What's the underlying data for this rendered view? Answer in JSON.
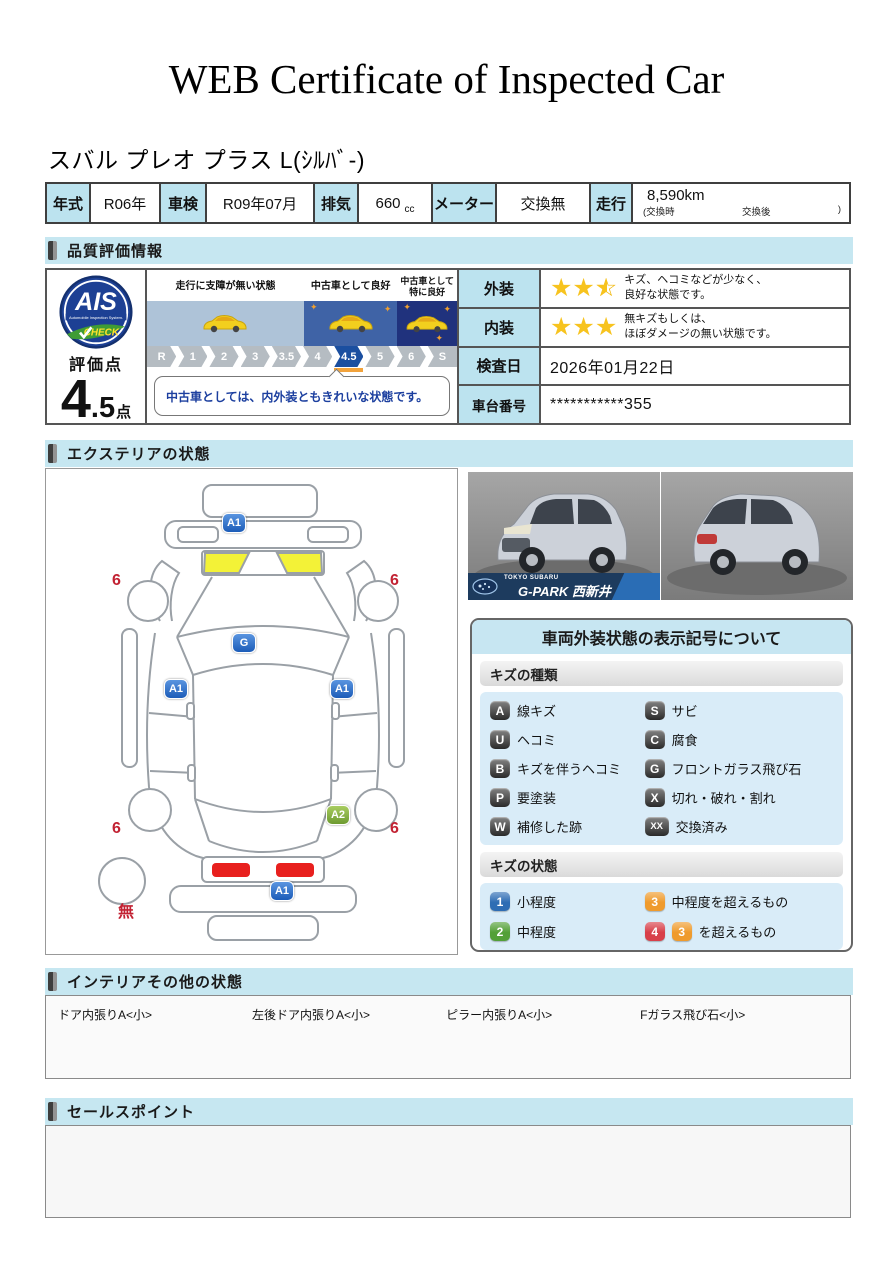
{
  "page": {
    "title": "WEB Certificate of Inspected Car"
  },
  "vehicle": {
    "name": "スバル プレオ プラス L(ｼﾙﾊﾞ-)"
  },
  "icons": {
    "sparkle": "✦",
    "star_full": "★",
    "star_outline": "☆",
    "check": "✓"
  },
  "specs": {
    "year_label": "年式",
    "year": "R06年",
    "inspection_label": "車検",
    "inspection": "R09年07月",
    "displacement_label": "排気",
    "displacement": "660",
    "displacement_unit": "cc",
    "meter_label": "メーター",
    "meter": "交換無",
    "mileage_label": "走行",
    "mileage": "8,590km",
    "mileage_note_left": "(交換時",
    "mileage_note_mid": "交換後",
    "mileage_note_right": ")"
  },
  "sections": {
    "quality": "品質評価情報",
    "exterior": "エクステリアの状態",
    "interior": "インテリアその他の状態",
    "sales": "セールスポイント"
  },
  "quality": {
    "logo": {
      "line1": "AIS",
      "line2": "Automobile Inspection System.",
      "line3": "CHECK"
    },
    "score_label": "評価点",
    "score_main": "4",
    "score_decimal": ".5",
    "score_unit": "点",
    "scale_panels": [
      {
        "label": "走行に支障が無い状態",
        "band_color": "#aec3d8",
        "sparkles": 0
      },
      {
        "label": "中古車として良好",
        "band_color": "#3f63a6",
        "sparkles": 2
      },
      {
        "label": "中古車として特に良好",
        "band_color": "#20327d",
        "sparkles": 3
      }
    ],
    "scale": [
      "R",
      "1",
      "2",
      "3",
      "3.5",
      "4",
      "4.5",
      "5",
      "6",
      "S"
    ],
    "active_scale": "4.5",
    "comment": "中古車としては、内外装ともきれいな状態です。",
    "rows": [
      {
        "label": "外装",
        "stars": 2.5,
        "text": "キズ、ヘコミなどが少なく、\n良好な状態です。"
      },
      {
        "label": "内装",
        "stars": 3,
        "text": "無キズもしくは、\nほぼダメージの無い状態です。"
      },
      {
        "label": "検査日",
        "value": "2026年01月22日"
      },
      {
        "label": "車台番号",
        "value": "***********355"
      }
    ]
  },
  "exterior": {
    "markers": [
      {
        "t": "A1",
        "type": "blue",
        "x": 176,
        "y": 44
      },
      {
        "t": "G",
        "type": "blue",
        "x": 186,
        "y": 164
      },
      {
        "t": "A1",
        "type": "blue",
        "x": 118,
        "y": 210
      },
      {
        "t": "A1",
        "type": "blue",
        "x": 284,
        "y": 210
      },
      {
        "t": "A2",
        "type": "green",
        "x": 280,
        "y": 336
      },
      {
        "t": "A1",
        "type": "blue",
        "x": 224,
        "y": 412
      }
    ],
    "labels": [
      {
        "t": "6",
        "x": 66,
        "y": 104
      },
      {
        "t": "6",
        "x": 344,
        "y": 104
      },
      {
        "t": "6",
        "x": 66,
        "y": 352
      },
      {
        "t": "6",
        "x": 344,
        "y": 352
      },
      {
        "t": "無",
        "x": 72,
        "y": 436
      }
    ],
    "photo_banner": {
      "small": "TOKYO SUBARU",
      "large": "G-PARK 西新井"
    },
    "legend": {
      "title": "車両外装状態の表示記号について",
      "kind_header": "キズの種類",
      "kinds": [
        {
          "code": "A",
          "label": "線キズ"
        },
        {
          "code": "S",
          "label": "サビ"
        },
        {
          "code": "U",
          "label": "ヘコミ"
        },
        {
          "code": "C",
          "label": "腐食"
        },
        {
          "code": "B",
          "label": "キズを伴うヘコミ"
        },
        {
          "code": "G",
          "label": "フロントガラス飛び石"
        },
        {
          "code": "P",
          "label": "要塗装"
        },
        {
          "code": "X",
          "label": "切れ・破れ・割れ"
        },
        {
          "code": "W",
          "label": "補修した跡"
        },
        {
          "code": "XX",
          "label": "交換済み"
        }
      ],
      "state_header": "キズの状態",
      "states": [
        {
          "codes": [
            {
              "t": "1",
              "c": "#2e6db4"
            }
          ],
          "label": "小程度"
        },
        {
          "codes": [
            {
              "t": "3",
              "c": "#ef9b2d"
            }
          ],
          "label": "中程度を超えるもの"
        },
        {
          "codes": [
            {
              "t": "2",
              "c": "#53a038"
            }
          ],
          "label": "中程度"
        },
        {
          "codes": [
            {
              "t": "4",
              "c": "#d8404a"
            },
            {
              "t": "3",
              "c": "#ef9b2d"
            }
          ],
          "label": "を超えるもの"
        }
      ]
    }
  },
  "interior": {
    "items": [
      "ドア内張りA<小>",
      "左後ドア内張りA<小>",
      "ピラー内張りA<小>",
      "Fガラス飛び石<小>"
    ]
  }
}
